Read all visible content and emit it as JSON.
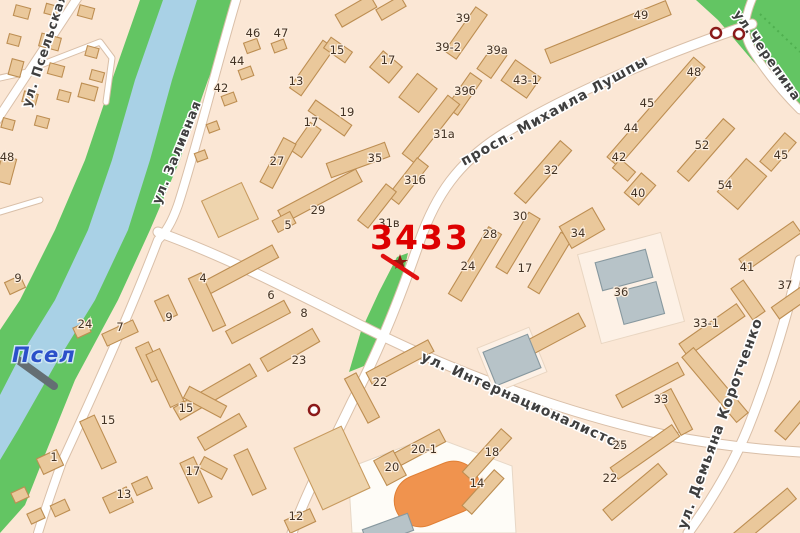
{
  "map": {
    "marker": {
      "label": "3433",
      "color": "#dd0000"
    },
    "river_label": {
      "text": "Псел",
      "color": "#2b50c9"
    },
    "street_labels": [
      {
        "text": "ул. Псельская",
        "x": 30,
        "y": 108,
        "rotate": -72,
        "size": 13
      },
      {
        "text": "ул. Заливная",
        "x": 160,
        "y": 205,
        "rotate": -68,
        "size": 13
      },
      {
        "text": "просп. Михаила Лушпы",
        "x": 464,
        "y": 166,
        "rotate": -29,
        "size": 14
      },
      {
        "text": "ул.Черепина",
        "x": 733,
        "y": 14,
        "rotate": 55,
        "size": 13
      },
      {
        "text": "ул. Интернационалистов",
        "x": 420,
        "y": 360,
        "rotate": 24,
        "size": 14
      },
      {
        "text": "ул. Демьяна Коротченко",
        "x": 686,
        "y": 530,
        "rotate": -70,
        "size": 14
      }
    ],
    "house_numbers": [
      {
        "n": "46",
        "x": 253,
        "y": 33
      },
      {
        "n": "47",
        "x": 281,
        "y": 33
      },
      {
        "n": "44",
        "x": 237,
        "y": 61
      },
      {
        "n": "42",
        "x": 221,
        "y": 88
      },
      {
        "n": "48",
        "x": 7,
        "y": 157
      },
      {
        "n": "9",
        "x": 18,
        "y": 278
      },
      {
        "n": "24",
        "x": 85,
        "y": 324
      },
      {
        "n": "7",
        "x": 120,
        "y": 327
      },
      {
        "n": "9",
        "x": 169,
        "y": 317
      },
      {
        "n": "4",
        "x": 203,
        "y": 278
      },
      {
        "n": "6",
        "x": 271,
        "y": 295
      },
      {
        "n": "8",
        "x": 304,
        "y": 313
      },
      {
        "n": "5",
        "x": 288,
        "y": 225
      },
      {
        "n": "29",
        "x": 318,
        "y": 210
      },
      {
        "n": "23",
        "x": 299,
        "y": 360
      },
      {
        "n": "15",
        "x": 108,
        "y": 420
      },
      {
        "n": "15",
        "x": 186,
        "y": 408
      },
      {
        "n": "1",
        "x": 54,
        "y": 457
      },
      {
        "n": "13",
        "x": 124,
        "y": 494
      },
      {
        "n": "17",
        "x": 193,
        "y": 471
      },
      {
        "n": "12",
        "x": 296,
        "y": 516
      },
      {
        "n": "22",
        "x": 380,
        "y": 382
      },
      {
        "n": "20-1",
        "x": 424,
        "y": 449
      },
      {
        "n": "20",
        "x": 392,
        "y": 467
      },
      {
        "n": "18",
        "x": 492,
        "y": 452
      },
      {
        "n": "14",
        "x": 477,
        "y": 483
      },
      {
        "n": "33",
        "x": 661,
        "y": 399
      },
      {
        "n": "25",
        "x": 620,
        "y": 445
      },
      {
        "n": "22",
        "x": 610,
        "y": 478
      },
      {
        "n": "33-1",
        "x": 706,
        "y": 323
      },
      {
        "n": "41",
        "x": 747,
        "y": 267
      },
      {
        "n": "37",
        "x": 785,
        "y": 285
      },
      {
        "n": "36",
        "x": 621,
        "y": 292
      },
      {
        "n": "34",
        "x": 578,
        "y": 233
      },
      {
        "n": "30",
        "x": 520,
        "y": 216
      },
      {
        "n": "28",
        "x": 490,
        "y": 234
      },
      {
        "n": "24",
        "x": 468,
        "y": 266
      },
      {
        "n": "17",
        "x": 525,
        "y": 268
      },
      {
        "n": "32",
        "x": 551,
        "y": 170
      },
      {
        "n": "52",
        "x": 702,
        "y": 145
      },
      {
        "n": "45",
        "x": 781,
        "y": 155
      },
      {
        "n": "54",
        "x": 725,
        "y": 185
      },
      {
        "n": "40",
        "x": 638,
        "y": 193
      },
      {
        "n": "42",
        "x": 619,
        "y": 157
      },
      {
        "n": "44",
        "x": 631,
        "y": 128
      },
      {
        "n": "45",
        "x": 647,
        "y": 103
      },
      {
        "n": "48",
        "x": 694,
        "y": 72
      },
      {
        "n": "49",
        "x": 641,
        "y": 15
      },
      {
        "n": "43-1",
        "x": 526,
        "y": 80
      },
      {
        "n": "39а",
        "x": 497,
        "y": 50
      },
      {
        "n": "39-2",
        "x": 448,
        "y": 47
      },
      {
        "n": "39",
        "x": 463,
        "y": 18
      },
      {
        "n": "39б",
        "x": 465,
        "y": 91
      },
      {
        "n": "31а",
        "x": 444,
        "y": 134
      },
      {
        "n": "31б",
        "x": 415,
        "y": 180
      },
      {
        "n": "31в",
        "x": 389,
        "y": 223
      },
      {
        "n": "35",
        "x": 375,
        "y": 158
      },
      {
        "n": "27",
        "x": 277,
        "y": 161
      },
      {
        "n": "13",
        "x": 296,
        "y": 81
      },
      {
        "n": "15",
        "x": 337,
        "y": 50
      },
      {
        "n": "17",
        "x": 388,
        "y": 60
      },
      {
        "n": "19",
        "x": 347,
        "y": 112
      },
      {
        "n": "17",
        "x": 311,
        "y": 122
      }
    ],
    "junction_markers": [
      {
        "x": 716,
        "y": 33
      },
      {
        "x": 739,
        "y": 34
      },
      {
        "x": 314,
        "y": 410
      }
    ],
    "colors": {
      "background": "#fbe7d5",
      "water": "#a9d1e6",
      "park": "#63c563",
      "building": "#eac89b",
      "building_outline": "#bd8e52",
      "gray_building": "#b7c3c8",
      "road": "#ffffff",
      "stadium": "#f0934e",
      "marker_red": "#dd0000",
      "junction_ring": "#8b1a1a"
    }
  }
}
